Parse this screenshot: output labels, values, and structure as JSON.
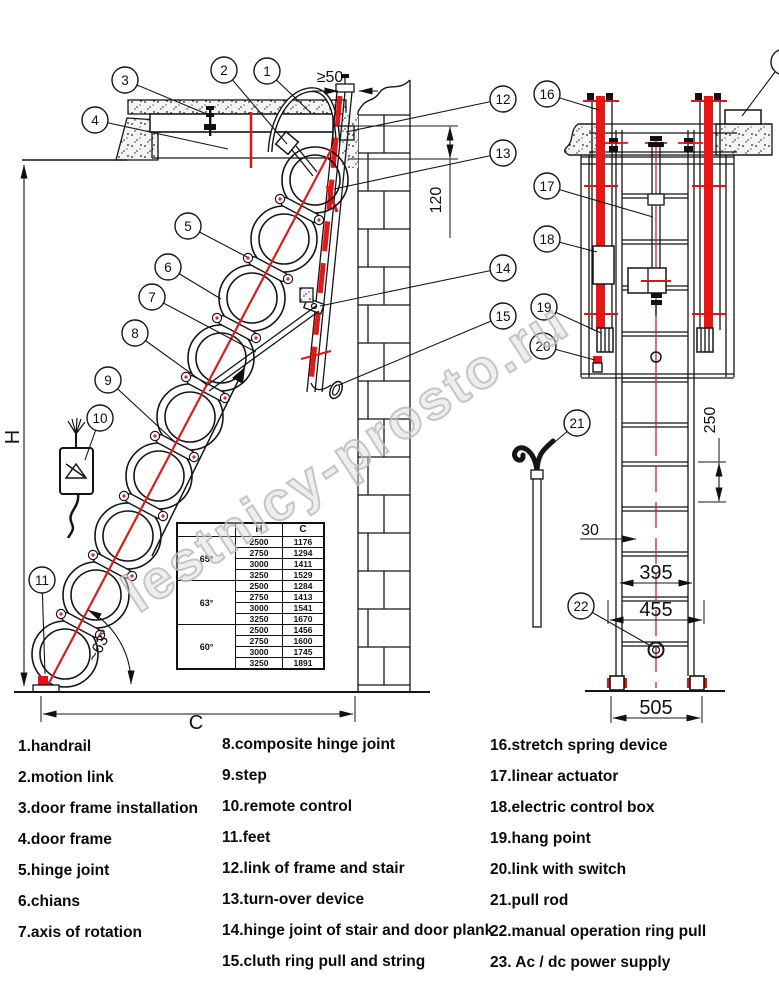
{
  "watermark": "lestnicy-prosto.ru",
  "dims": {
    "clearance": "≥50",
    "plank_offset": "120",
    "height": "H",
    "width": "C",
    "angle": "~63°",
    "rung_span": "250",
    "step_depth": "30",
    "inner_width": "395",
    "mid_width": "455",
    "outer_width": "505"
  },
  "callouts": {
    "c1": "1",
    "c2": "2",
    "c3": "3",
    "c4": "4",
    "c5": "5",
    "c6": "6",
    "c7": "7",
    "c8": "8",
    "c9": "9",
    "c10": "10",
    "c11": "11",
    "c12": "12",
    "c13": "13",
    "c14": "14",
    "c15": "15",
    "c16": "16",
    "c17": "17",
    "c18": "18",
    "c19": "19",
    "c20": "20",
    "c21": "21",
    "c22": "22"
  },
  "table": {
    "headers": [
      "",
      "H",
      "C"
    ],
    "groups": [
      {
        "angle": "65°",
        "rows": [
          [
            "2500",
            "1176"
          ],
          [
            "2750",
            "1294"
          ],
          [
            "3000",
            "1411"
          ],
          [
            "3250",
            "1529"
          ]
        ]
      },
      {
        "angle": "63°",
        "rows": [
          [
            "2500",
            "1284"
          ],
          [
            "2750",
            "1413"
          ],
          [
            "3000",
            "1541"
          ],
          [
            "3250",
            "1670"
          ]
        ]
      },
      {
        "angle": "60°",
        "rows": [
          [
            "2500",
            "1456"
          ],
          [
            "2750",
            "1600"
          ],
          [
            "3000",
            "1745"
          ],
          [
            "3250",
            "1891"
          ]
        ]
      }
    ]
  },
  "legend": {
    "col1": [
      "1.handrail",
      "2.motion link",
      "3.door frame installation",
      "4.door frame",
      "5.hinge joint",
      "6.chians",
      "7.axis of rotation"
    ],
    "col2": [
      "8.composite hinge joint",
      "9.step",
      "10.remote control",
      "11.feet",
      "12.link of frame and stair",
      "13.turn-over device",
      "14.hinge joint of stair and door plank",
      "15.cluth ring pull and string"
    ],
    "col3": [
      "16.stretch spring device",
      "17.linear actuator",
      "18.electric control box",
      "19.hang point",
      "20.link with switch",
      "21.pull rod",
      "22.manual operation ring pull",
      "23. Ac / dc power supply"
    ]
  },
  "colors": {
    "line": "#151515",
    "red": "#e01414",
    "watermark": "#cccccc"
  }
}
